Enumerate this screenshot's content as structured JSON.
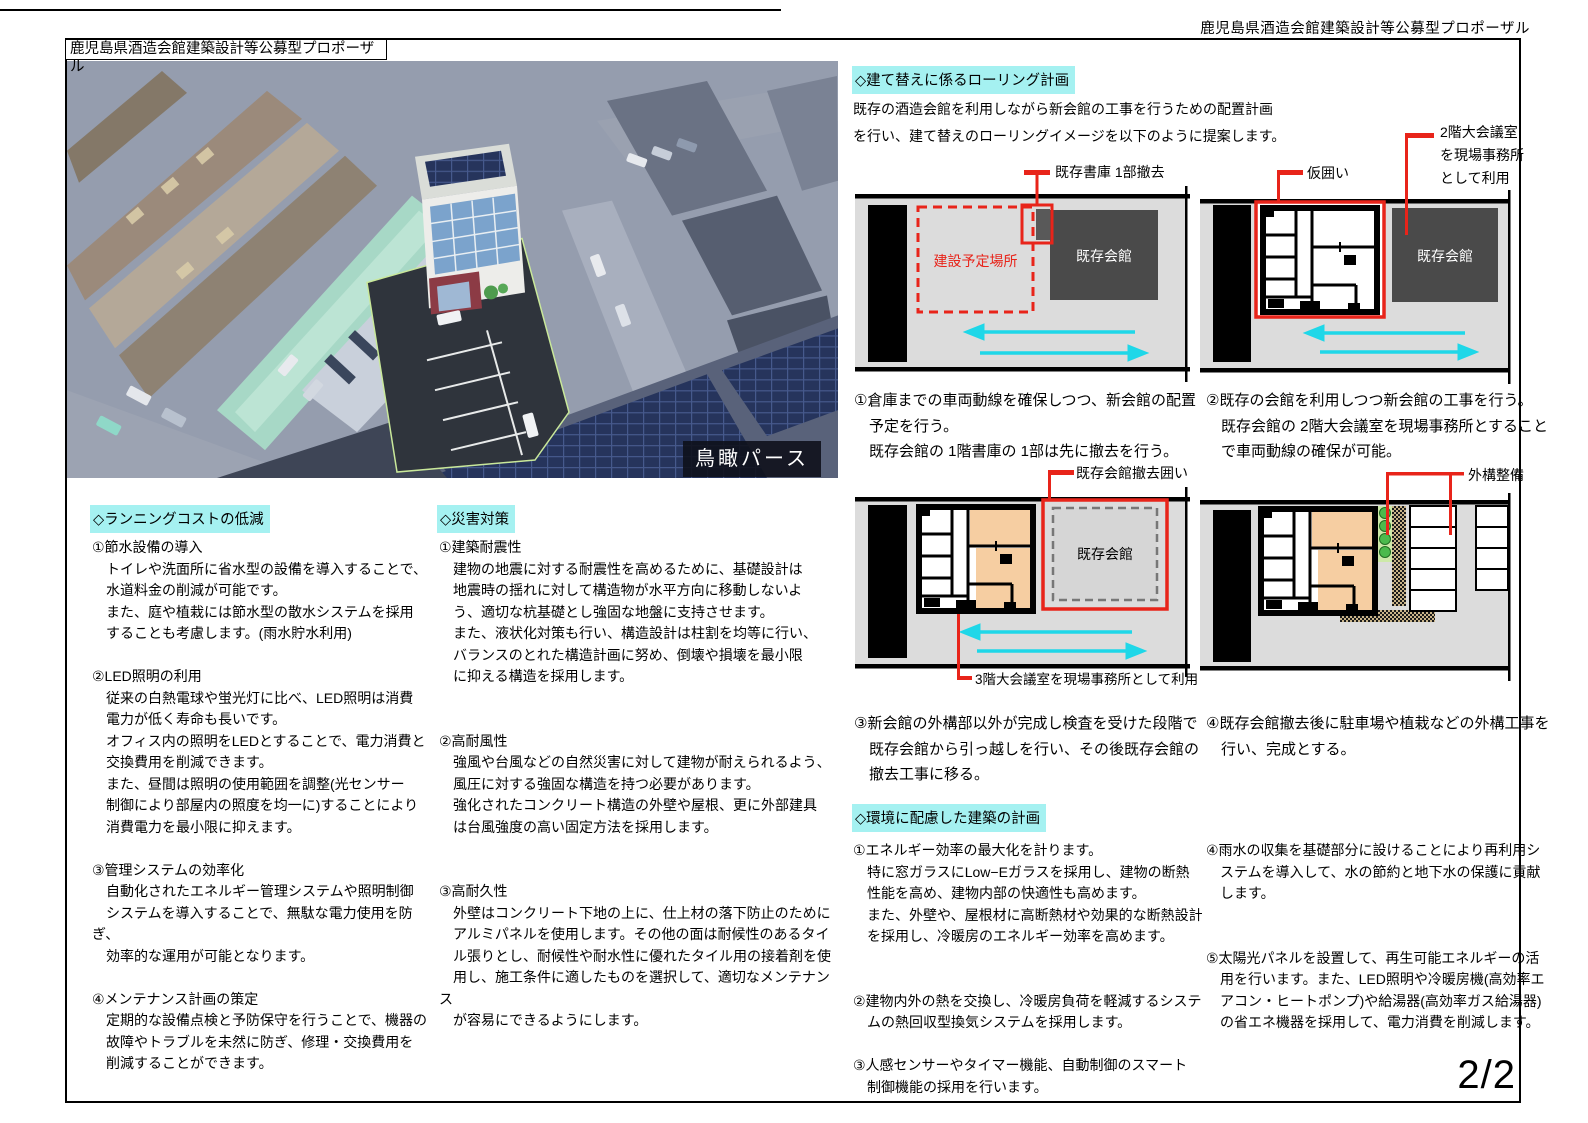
{
  "header": {
    "right_title": "鹿児島県酒造会館建築設計等公募型プロポーザル",
    "board_title": "鹿児島県酒造会館建築設計等公募型プロポーザル"
  },
  "photo": {
    "caption": "鳥瞰パース"
  },
  "rolling": {
    "heading": "◇建て替えに係るローリング計画",
    "intro": "既存の酒造会館を利用しながら新会館の工事を行うための配置計画\nを行い、建て替えのローリングイメージを以下のように提案します。",
    "d1": {
      "callout": "既存書庫 1部撤去",
      "site": "建設予定場所",
      "hall": "既存会館",
      "caption": "①倉庫までの車両動線を確保しつつ、新会館の配置\n　予定を行う。\n　既存会館の 1階書庫の 1部は先に撤去を行う。"
    },
    "d2": {
      "callout_fence": "仮囲い",
      "callout_office": "2階大会議室\nを現場事務所\nとして利用",
      "hall": "既存会館",
      "caption": "②既存の会館を利用しつつ新会館の工事を行う。\n　既存会館の 2階大会議室を現場事務所とすること\n　で車両動線の確保が可能。"
    },
    "d3": {
      "callout": "既存会館撤去囲い",
      "hall": "既存会館",
      "callout_office": "3階大会議室を現場事務所として利用",
      "caption": "③新会館の外構部以外が完成し検査を受けた段階で\n　既存会館から引っ越しを行い、その後既存会館の\n　撤去工事に移る。"
    },
    "d4": {
      "callout": "外構整備",
      "caption": "④既存会館撤去後に駐車場や植栽などの外構工事を\n　行い、完成とする。"
    }
  },
  "running_cost": {
    "heading": "◇ランニングコストの低減",
    "body": "①節水設備の導入\n　トイレや洗面所に省水型の設備を導入することで、\n　水道料金の削減が可能です。\n　また、庭や植栽には節水型の散水システムを採用\n　することも考慮します。(雨水貯水利用)\n\n②LED照明の利用\n　従来の白熱電球や蛍光灯に比べ、LED照明は消費\n　電力が低く寿命も長いです。\n　オフィス内の照明をLEDとすることで、電力消費と\n　交換費用を削減できます。\n　また、昼間は照明の使用範囲を調整(光センサー\n　制御により部屋内の照度を均一に)することにより\n　消費電力を最小限に抑えます。\n\n③管理システムの効率化\n　自動化されたエネルギー管理システムや照明制御\n　システムを導入することで、無駄な電力使用を防ぎ、\n　効率的な運用が可能となります。\n\n④メンテナンス計画の策定\n　定期的な設備点検と予防保守を行うことで、機器の\n　故障やトラブルを未然に防ぎ、修理・交換費用を\n　削減することができます。"
  },
  "disaster": {
    "heading": "◇災害対策",
    "body": "①建築耐震性\n　建物の地震に対する耐震性を高めるために、基礎設計は\n　地震時の揺れに対して構造物が水平方向に移動しないよ\n　う、適切な杭基礎とし強固な地盤に支持させます。\n　また、液状化対策も行い、構造設計は柱割を均等に行い、\n　バランスのとれた構造計画に努め、倒壊や損壊を最小限\n　に抑える構造を採用します。\n\n\n②高耐風性\n　強風や台風などの自然災害に対して建物が耐えられるよう、\n　風圧に対する強固な構造を持つ必要があります。\n　強化されたコンクリート構造の外壁や屋根、更に外部建具\n　は台風強度の高い固定方法を採用します。\n\n\n③高耐久性\n　外壁はコンクリート下地の上に、仕上材の落下防止のために\n　アルミパネルを使用します。その他の面は耐候性のあるタイ\n　ル張りとし、耐候性や耐水性に優れたタイル用の接着剤を使\n　用し、施工条件に適したものを選択して、適切なメンテナンス\n　が容易にできるようにします。"
  },
  "environment": {
    "heading": "◇環境に配慮した建築の計画",
    "col1": "①エネルギー効率の最大化を計ります。\n　特に窓ガラスにLow−Eガラスを採用し、建物の断熱\n　性能を高め、建物内部の快適性も高めます。\n　また、外壁や、屋根材に高断熱材や効果的な断熱設計\n　を採用し、冷暖房のエネルギー効率を高めます。\n\n\n②建物内外の熱を交換し、冷暖房負荷を軽減するシステ\n　ムの熱回収型換気システムを採用します。\n\n③人感センサーやタイマー機能、自動制御のスマート\n　制御機能の採用を行います。",
    "col2": "④雨水の収集を基礎部分に設けることにより再利用シ\n　ステムを導入して、水の節約と地下水の保護に貢献\n　します。\n\n\n⑤太陽光パネルを設置して、再生可能エネルギーの活\n　用を行います。また、LED照明や冷暖房機(高効率エ\n　アコン・ヒートポンプ)や給湯器(高効率ガス給湯器)\n　の省エネ機器を採用して、電力消費を削減します。"
  },
  "colors": {
    "highlight_cyan": "#A5F1F1",
    "callout_red": "#E8241A",
    "arrow_cyan": "#1FD7E8",
    "room_orange": "#F6CEA2",
    "hall_gray": "#4A4A4A"
  },
  "page_number": "2/2"
}
